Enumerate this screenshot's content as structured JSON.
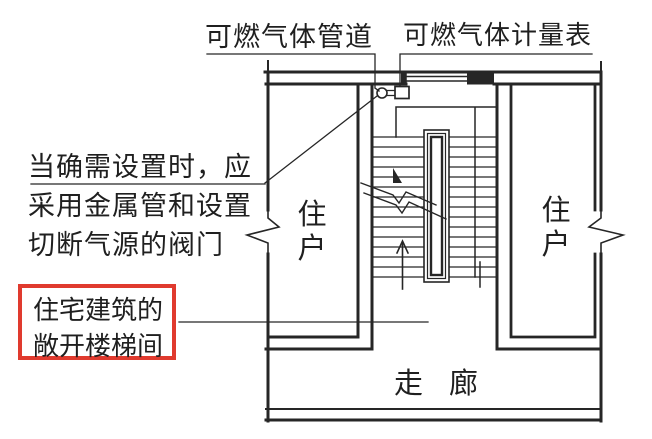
{
  "colors": {
    "ink": "#262626",
    "highlight_red": "#e03a2e",
    "background": "#ffffff"
  },
  "annotations": {
    "gas_pipe_label": "可燃气体管道",
    "gas_meter_label": "可燃气体计量表",
    "note": {
      "line1": "当确需设置时，应",
      "line2": "采用金属管和设置",
      "line3": "切断气源的阀门"
    },
    "highlight": {
      "line1": "住宅建筑的",
      "line2": "敞开楼梯间"
    }
  },
  "plan": {
    "unit_left_label": "住户",
    "unit_right_label": "住户",
    "corridor_label": "走廊"
  },
  "icons": {
    "valve": "gas-valve-icon",
    "meter": "gas-meter-icon",
    "wall_break": "wall-break-icon",
    "up_arrow": "stair-up-arrow-icon"
  }
}
